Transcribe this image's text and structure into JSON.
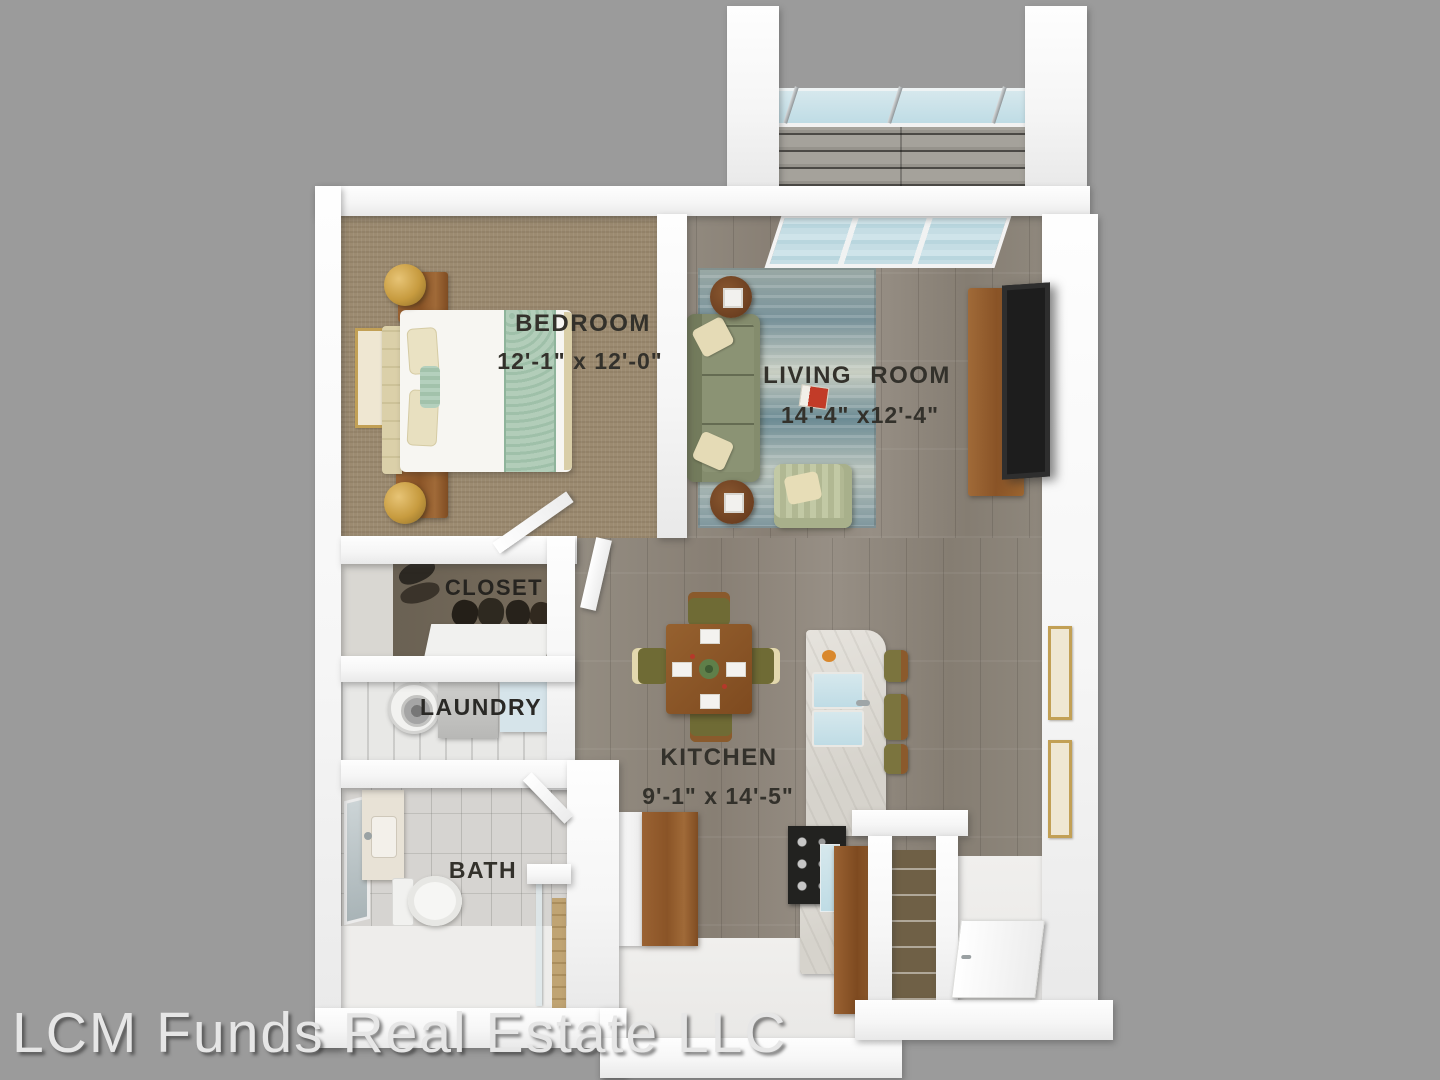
{
  "watermark": {
    "text": "LCM Funds Real Estate LLC"
  },
  "rooms": {
    "bedroom": {
      "label": "BEDROOM",
      "dims": "12'-1\" x 12'-0\""
    },
    "living": {
      "label": "LIVING ROOM",
      "dims": "14'-4\" x12'-4\""
    },
    "closet": {
      "label": "CLOSET"
    },
    "laundry": {
      "label": "LAUNDRY"
    },
    "kitchen": {
      "label": "KITCHEN",
      "dims": "9'-1\" x 14'-5\""
    },
    "bath": {
      "label": "BATH"
    }
  },
  "colors": {
    "background": "#9b9b9b",
    "walls": "#f6f6f6",
    "wood_floor": "#8e877c",
    "bedroom_carpet": "#9c8b71",
    "cabinet_wood": "#8a5427",
    "rug_teal": "#7e969d",
    "sofa_green": "#848c6d",
    "glass_blue": "#cfe4ea",
    "label_text": "#33312b",
    "watermark_text": "#e6e6e6"
  }
}
